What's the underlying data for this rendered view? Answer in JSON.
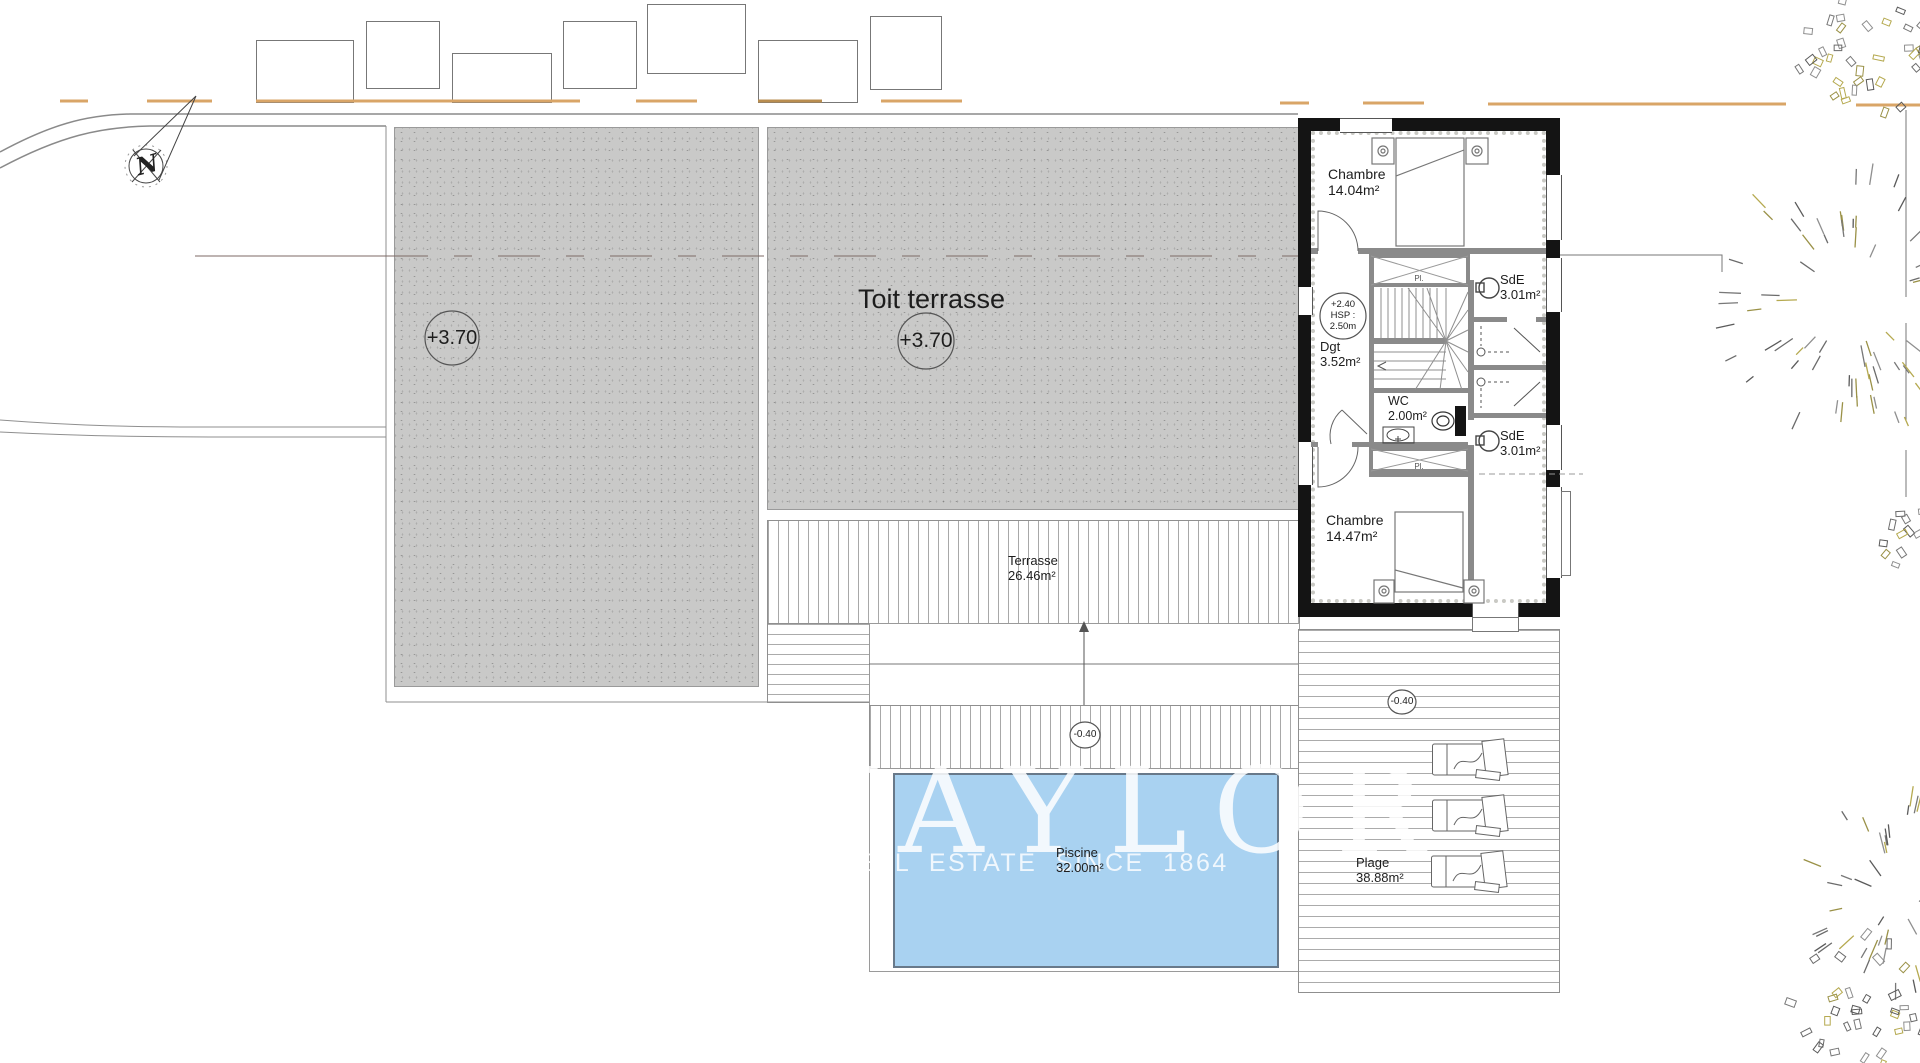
{
  "plan": {
    "roof": {
      "title": "Toit terrasse",
      "level_left": "+3.70",
      "level_right": "+3.70"
    },
    "rooms": {
      "chambre_top": {
        "name": "Chambre",
        "area": "14.04m²"
      },
      "sde_top": {
        "name": "SdE",
        "area": "3.01m²"
      },
      "dgt": {
        "name": "Dgt",
        "area": "3.52m²"
      },
      "stair_note": {
        "line1": "+2.40",
        "line2": "HSP :",
        "line3": "2.50m"
      },
      "wc": {
        "name": "WC",
        "area": "2.00m²"
      },
      "sde_bottom": {
        "name": "SdE",
        "area": "3.01m²"
      },
      "chambre_bottom": {
        "name": "Chambre",
        "area": "14.47m²"
      },
      "closet_top": "Pl.",
      "closet_bottom": "Pl."
    },
    "outdoor": {
      "terrasse": {
        "name": "Terrasse",
        "area": "26.46m²",
        "level": "-0.40"
      },
      "piscine": {
        "name": "Piscine",
        "area": "32.00m²"
      },
      "plage": {
        "name": "Plage",
        "area": "38.88m²",
        "level": "-0.40"
      }
    },
    "compass": "N",
    "watermark": {
      "brand": "TAYLOR",
      "tagline": "REAL ESTATE SINCE 1864"
    },
    "colors": {
      "pool": "#A9D2F1",
      "roof": "#C9C9C8",
      "wall": "#141414",
      "partition": "#8A8A8A",
      "road_dash": "#D9A567"
    }
  }
}
